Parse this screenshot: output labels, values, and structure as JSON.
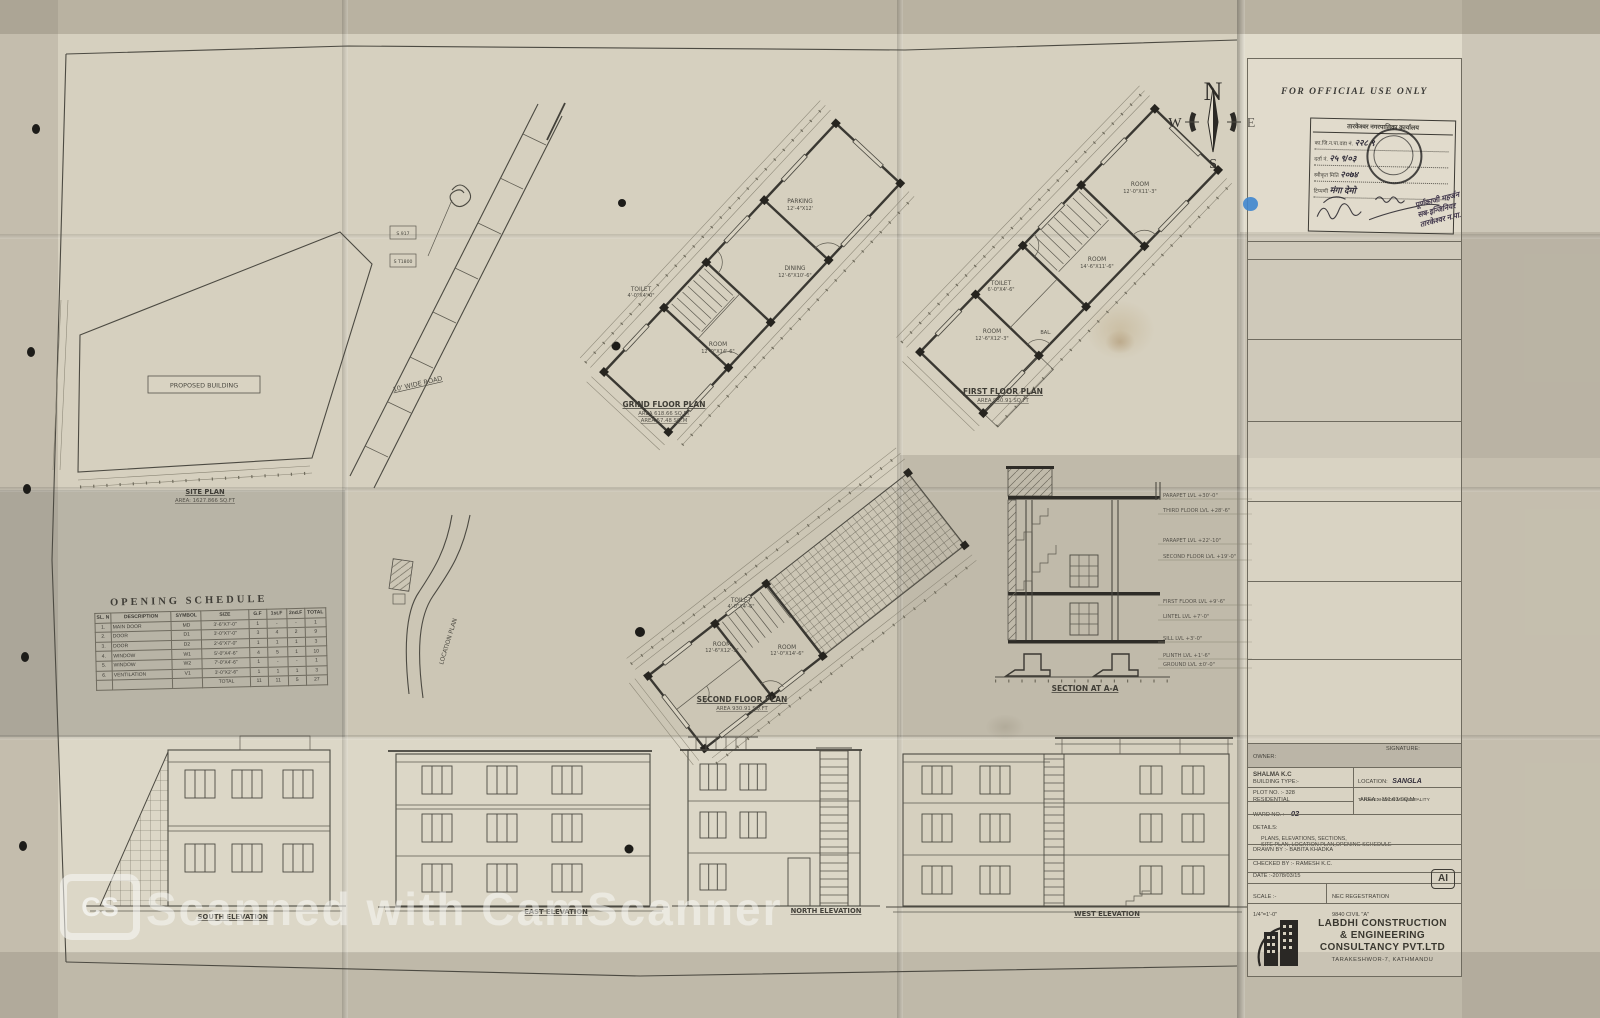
{
  "compass": {
    "n": "N",
    "e": "E",
    "s": "S",
    "w": "W"
  },
  "official_box": {
    "title": "FOR OFFICIAL USE ONLY",
    "stamp_header": "तारकेश्वर नगरपालिका कार्यालय",
    "stamp_rows": [
      {
        "label": "का.जि.न.पा.वडा नं.",
        "value": "२२८ ९"
      },
      {
        "label": "दर्ता नं.",
        "value": "२५ ९/०३"
      },
      {
        "label": "स्वीकृत मिति",
        "value": "२०७४"
      },
      {
        "label": "टिप्पणी",
        "value": "मंगा देमो"
      }
    ],
    "note_line1": "पूर्णकाजी महर्जन",
    "note_line2": "सब-इन्जिनियर",
    "note_line3": "तारकेश्वर न.पा."
  },
  "site_plan": {
    "label": "SITE PLAN",
    "area": "AREA: 1627.866 SQ.FT",
    "proposed_building": "PROPOSED BUILDING",
    "road_label": "10' WIDE ROAD",
    "marker1": "S 917",
    "marker2": "S T1800"
  },
  "location_plan": {
    "label": "LOCATION PLAN"
  },
  "ground_plan": {
    "label": "GRIND FLOOR PLAN",
    "area1": "AREA 618.66 SQ.FT",
    "area2": "AREA 57.48 SQ.M",
    "rooms": {
      "parking": {
        "name": "PARKING",
        "size": "12'-4\"X12'"
      },
      "dining": {
        "name": "DINING",
        "size": "12'-6\"X10'-6\""
      },
      "toilet": {
        "name": "TOILET",
        "size": "4'-0\"X4'-0\""
      },
      "room": {
        "name": "ROOM",
        "size": "12'-0\"X14'-6\""
      }
    }
  },
  "first_plan": {
    "label": "FIRST FLOOR PLAN",
    "area": "AREA 930.91 SQ.FT",
    "rooms": {
      "room1": {
        "name": "ROOM",
        "size": "12'-0\"X11'-3\""
      },
      "room2": {
        "name": "ROOM",
        "size": "14'-6\"X11'-6\""
      },
      "toilet": {
        "name": "TOILET",
        "size": "6'-0\"X4'-6\""
      },
      "room3": {
        "name": "ROOM",
        "size": "12'-6\"X12'-3\""
      },
      "balcony": {
        "name": "BAL."
      }
    }
  },
  "second_plan": {
    "label": "SECOND FLOOR PLAN",
    "area": "AREA 930.91 SQ.FT",
    "rooms": {
      "toilet": {
        "name": "TOILET",
        "size": "4'-0\"X4'-6\""
      },
      "room1": {
        "name": "ROOM",
        "size": "12'-6\"X12'-3\""
      },
      "room2": {
        "name": "ROOM",
        "size": "12'-0\"X14'-6\""
      }
    }
  },
  "section": {
    "label": "SECTION AT A-A",
    "levels": [
      "PARAPET LVL +30'-0\"",
      "THIRD FLOOR LVL +28'-6\"",
      "PARAPET LVL +22'-10\"",
      "SECOND FLOOR LVL +19'-0\"",
      "FIRST FLOOR LVL +9'-6\"",
      "LINTEL LVL +7'-0\"",
      "SILL LVL +3'-0\"",
      "PLINTH LVL +1'-6\"",
      "GROUND LVL ±0'-0\""
    ]
  },
  "opening_schedule": {
    "title": "OPENING SCHEDULE",
    "headers": [
      "SL. N",
      "DESCRIPTION",
      "SYMBOL",
      "SIZE",
      "G.F",
      "1st.F",
      "2nd.F",
      "TOTAL"
    ],
    "rows": [
      [
        "1.",
        "MAIN DOOR",
        "MD",
        "3'-6\"X7'-0\"",
        "1",
        "-",
        "-",
        "1"
      ],
      [
        "2.",
        "DOOR",
        "D1",
        "3'-0\"X7'-0\"",
        "3",
        "4",
        "2",
        "9"
      ],
      [
        "3.",
        "DOOR",
        "D2",
        "2'-6\"X7'-0\"",
        "1",
        "1",
        "1",
        "3"
      ],
      [
        "4.",
        "WINDOW",
        "W1",
        "5'-0\"X4'-6\"",
        "4",
        "5",
        "1",
        "10"
      ],
      [
        "5.",
        "WINDOW",
        "W2",
        "7'-0\"X4'-6\"",
        "1",
        "-",
        "-",
        "1"
      ],
      [
        "6.",
        "VENTILATION",
        "V1",
        "3'-0\"X2'-6\"",
        "1",
        "1",
        "1",
        "3"
      ],
      [
        "",
        "",
        "",
        "TOTAL",
        "11",
        "11",
        "5",
        "27"
      ]
    ]
  },
  "elevations": {
    "south": "SOUTH ELEVATION",
    "east": "EAST ELEVATION",
    "north": "NORTH ELEVATION",
    "west": "WEST ELEVATION"
  },
  "title_block": {
    "owner_label": "OWNER:",
    "owner_value": "SHALMA K.C",
    "signature_label": "SIGNATURE:",
    "building_type_label": "BUILDING TYPE:-",
    "building_type_value": "RESIDENTIAL",
    "location_label": "LOCATION:",
    "location_value": "SANGLA",
    "location_line2": "TARAKESHWOR MUNICIPALITY",
    "plot_label": "PLOT NO. :- 328",
    "ward_label": "WARD NO. :-",
    "ward_value": "02",
    "area_label": "AREA :- 151.03 SQ.M.",
    "details_label": "DETAILS:",
    "details_line1": "PLANS, ELEVATIONS, SECTIONS,",
    "details_line2": "SITE PLAN, LOCATION PLAN,OPENING SCHEDULE",
    "drawn_by": "DRAWN BY :- BABITA KHADKA",
    "checked_by": "CHECKED BY :- RAMESH K.C.",
    "date": "DATE :-2078/03/15",
    "scale_label": "SCALE :-",
    "scale_value": "1/4\"=1'-0\"",
    "nec_line1": "NEC REGESTRATION",
    "nec_line2": "9840 CIVIL \"A\"",
    "ai_badge": "AI",
    "company_line1": "LABDHI CONSTRUCTION",
    "company_line2": "& ENGINEERING",
    "company_line3": "CONSULTANCY PVT.LTD",
    "company_address": "TARAKESHWOR-7, KATHMANDU"
  },
  "watermark": {
    "logo": "CS",
    "text": "Scanned with CamScanner"
  }
}
